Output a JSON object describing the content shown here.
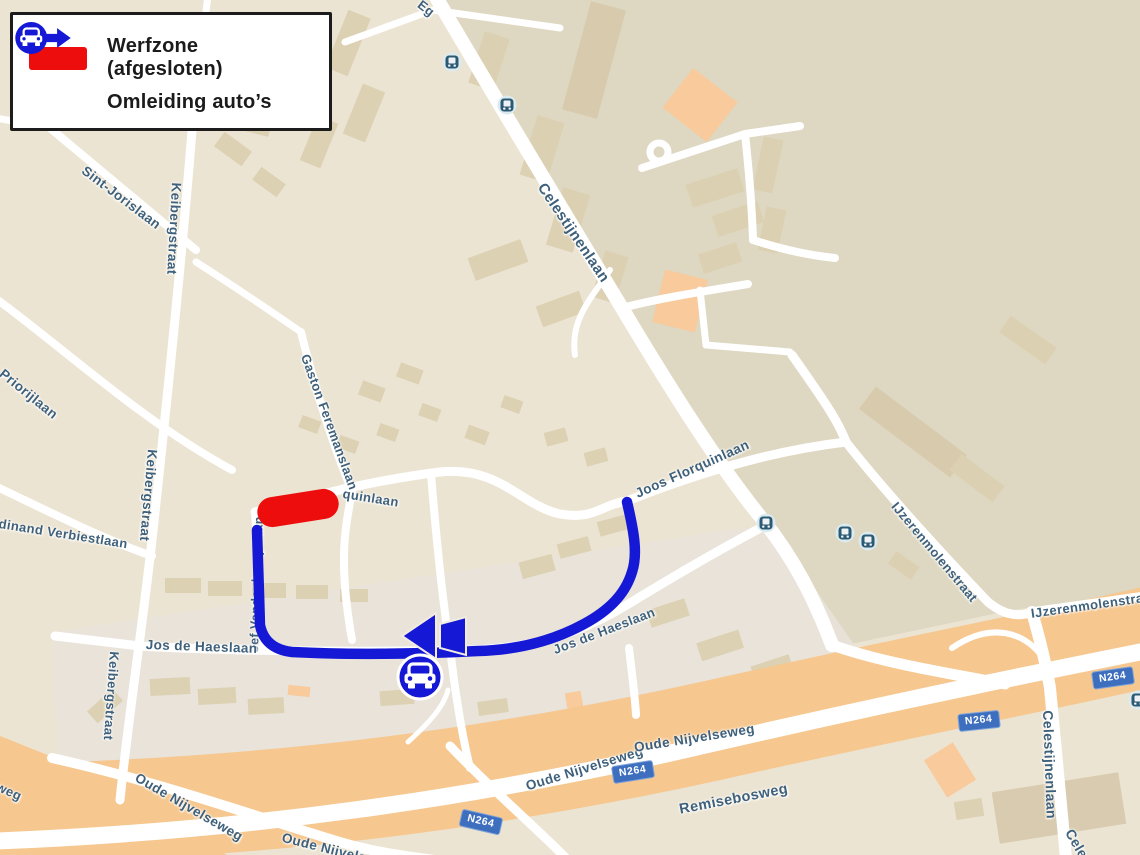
{
  "legend": {
    "items": [
      {
        "icon": "werfzone-swatch",
        "label": "Werfzone (afgesloten)"
      },
      {
        "icon": "car-detour-icon",
        "label": "Omleiding auto’s"
      }
    ]
  },
  "map": {
    "badge": "N264",
    "street_labels": [
      "Eg",
      "Sint-Jorislaan",
      "Keibergstraat",
      "Priorijlaan",
      "Keibergstraat",
      "dinand Verbiestlaan",
      "Gaston Feremanslaan",
      "quinlaan",
      "Joos Florquinlaan",
      "Celestijnenlaan",
      "Jef Vandenbemptlaan",
      "Jos de Haeslaan",
      "Jos de Haeslaan",
      "IJzerenmolenstraat",
      "IJzerenmolenstraat",
      "weg",
      "Oude Nijvelseweg",
      "Oude Nijvelseweg",
      "Oude Nijvelseweg",
      "Oude Nijvelseweg",
      "Remisebosweg",
      "Celestijnenlaan",
      "Celest",
      "Keibergstraat"
    ],
    "icons": {
      "bus_stop": "bus-stop-icon",
      "detour_car": "car-in-circle-icon",
      "detour_arrow": "arrow-left-icon"
    },
    "colors": {
      "background": "#ece4d2",
      "campus_area": "#ded7c1",
      "street": "#ffffff",
      "building": "#dccfb1",
      "highlight_building": "#f8ca9c",
      "motorway_band": "#f6c78e",
      "street_label": "#3e607b",
      "route_blue": "#1519d6",
      "werfzone_red": "#ee0d0d",
      "badge_blue": "#3e6fbf"
    }
  }
}
